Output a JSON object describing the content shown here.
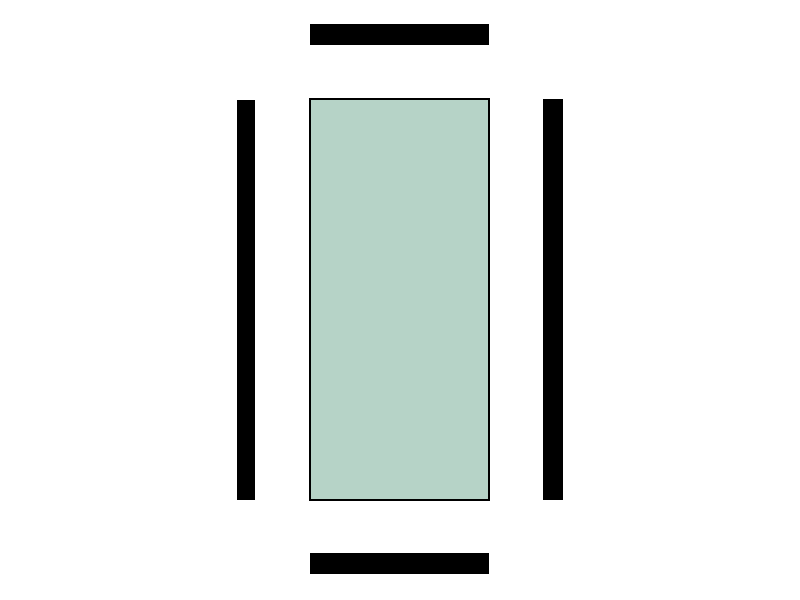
{
  "diagram": {
    "colors": {
      "background": "#ffffff",
      "bar": "#000000",
      "panel_fill": "#b6d3c7",
      "panel_border": "#000000"
    },
    "shapes": [
      {
        "name": "top-horizontal-bar"
      },
      {
        "name": "bottom-horizontal-bar"
      },
      {
        "name": "left-vertical-bar"
      },
      {
        "name": "right-vertical-bar"
      },
      {
        "name": "center-panel"
      }
    ]
  }
}
